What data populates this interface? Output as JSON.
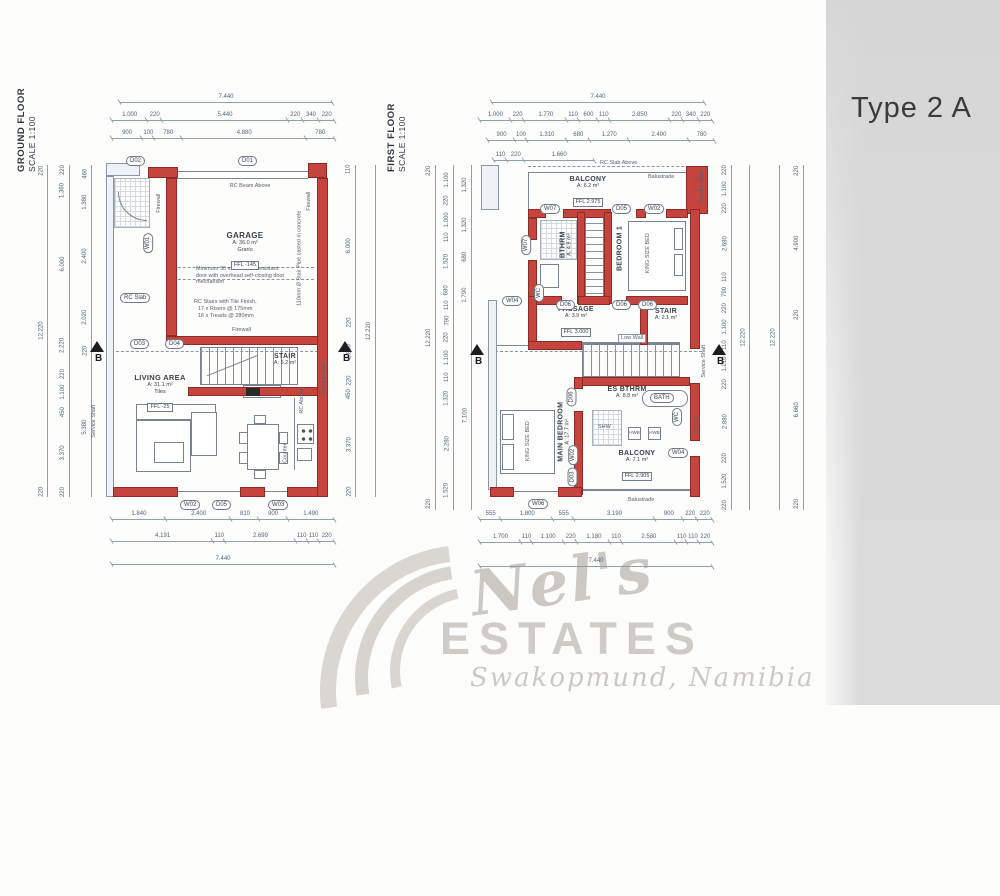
{
  "title": "Type 2 A",
  "watermark": {
    "name": "Nel's",
    "estates": "ESTATES",
    "location": "Swakopmund, Namibia"
  },
  "ground": {
    "floor_title": "GROUND FLOOR",
    "scale": "SCALE 1:100",
    "dims": {
      "top": [
        [
          "7.440"
        ],
        [
          "1.000",
          "220",
          "5.440",
          "220",
          "340",
          "220"
        ],
        [
          "900",
          "100",
          "780",
          "4.880",
          "780"
        ]
      ],
      "bottom": [
        [
          "1.840",
          "2.400",
          "810",
          "900",
          "1.490"
        ],
        [
          "4.191",
          "110",
          "2.699",
          "110",
          "110",
          "220"
        ],
        [
          "7.440"
        ]
      ],
      "left": [
        [
          "220",
          "12.220",
          "220"
        ],
        [
          "220",
          "1.360",
          "6.000",
          "2.220",
          "220",
          "1.100",
          "450",
          "3.370",
          "220"
        ],
        [
          "460",
          "1.380",
          "2.400",
          "2.020",
          "220",
          "5.380"
        ]
      ],
      "right": [
        [
          "110",
          "6.000",
          "220",
          "1.800",
          "220",
          "450",
          "3.370",
          "220"
        ],
        [
          "12.220"
        ]
      ]
    },
    "rooms": {
      "garage": {
        "name": "GARAGE",
        "area": "A: 36.0 m²",
        "finish": "Grano",
        "ffl": "FFL -145"
      },
      "stair": {
        "name": "STAIR",
        "area": "A: 5.2 m²"
      },
      "living": {
        "name": "LIVING AREA",
        "area": "A: 31.1 m²",
        "finish": "Tiles",
        "ffl": "FFL -25"
      }
    },
    "notes": {
      "rc_beam": "RC Beam Above",
      "fire_door": "Minimum 30 minutes fire resistant door with overhead self-closing door mechanism",
      "stairs1": "RC Stairs with Tile Finish,",
      "stairs2": "17 x Risers @ 175mm",
      "stairs3": "16 x Treads @ 280mm",
      "pipe": "110mm Ø Stair Pipe casted in concrete",
      "firewall": "Firewall",
      "rc_slab": "RC Slab",
      "rc_above": "RC Above",
      "counter": "Counter",
      "shaft": "Service Shaft",
      "section": "B"
    },
    "openings": {
      "d01": "D01",
      "d02": "D02",
      "d03": "D03",
      "d04": "D04",
      "d05": "D05",
      "w01": "W01",
      "w02": "W02",
      "w03": "W03"
    }
  },
  "first": {
    "floor_title": "FIRST FLOOR",
    "scale": "SCALE 1:100",
    "dims": {
      "top": [
        [
          "7.440"
        ],
        [
          "1.000",
          "220",
          "1.770",
          "110",
          "600",
          "110",
          "2.850",
          "220",
          "340",
          "220"
        ],
        [
          "900",
          "100",
          "1.310",
          "680",
          "1.270",
          "2.400",
          "780"
        ],
        [
          "110",
          "220",
          "1.660"
        ]
      ],
      "bottom": [
        [
          "555",
          "1.800",
          "555",
          "3.190",
          "900",
          "220",
          "220"
        ],
        [
          "1.700",
          "110",
          "1.100",
          "220",
          "1.180",
          "110",
          "2.580",
          "110",
          "110",
          "220"
        ],
        [
          "7.440"
        ]
      ],
      "left": [
        [
          "220",
          "12.220",
          "220"
        ],
        [
          "1.100",
          "220",
          "1.000",
          "110",
          "1.520",
          "680",
          "110",
          "790",
          "220",
          "1.100",
          "110",
          "1.320",
          "2.280",
          "1.520"
        ],
        [
          "1.320",
          "1.320",
          "680",
          "1.790",
          "7.100"
        ]
      ],
      "right": [
        [
          "220",
          "1.100",
          "220",
          "2.680",
          "110",
          "790",
          "220",
          "1.100",
          "110",
          "1.210",
          "220",
          "2.880",
          "220",
          "1.520",
          "220"
        ],
        [
          "12.220"
        ],
        [
          "12.220"
        ],
        [
          "220",
          "4.900",
          "220",
          "6.660",
          "220"
        ]
      ]
    },
    "rooms": {
      "balcony_top": {
        "name": "BALCONY",
        "area": "A: 6.2 m²",
        "finish": "Tiles",
        "ffl": "FFL 2.975"
      },
      "bthrm": {
        "name": "BTHRM",
        "area": "A: 4.9 m²",
        "finish": "Tiles"
      },
      "bedroom1": {
        "name": "BEDROOM 1",
        "bed": "KING SIZE BED"
      },
      "passage": {
        "name": "PASSAGE",
        "area": "A: 3.9 m²",
        "finish": "Tiles",
        "ffl": "FFL 3.000"
      },
      "stair": {
        "name": "STAIR",
        "area": "A: 2.1 m²"
      },
      "es_bthrm": {
        "name": "ES BTHRM",
        "area": "A: 8.8 m²",
        "finish": "Tiles"
      },
      "main_bedroom": {
        "name": "MAIN BEDROOM",
        "area": "A: 17.7 m²",
        "bed": "KING SIZE BED"
      },
      "balcony_bottom": {
        "name": "BALCONY",
        "area": "A: 7.1 m²",
        "finish": "Tiles",
        "ffl": "FFL 2.905"
      }
    },
    "notes": {
      "rc_slab_above": "RC Slab Above",
      "balustrade": "Balustrade",
      "low_wall": "Low Wall",
      "bath": "BATH",
      "wc": "WC",
      "shw": "SHW",
      "hwb": "HWB",
      "vp": "VP 550",
      "shaft": "Service Shaft",
      "section": "B"
    },
    "openings": {
      "w07": "W07",
      "d05": "D05",
      "w02": "W02",
      "w04": "W04",
      "w06": "W06",
      "d03": "D03",
      "d06": "D06"
    }
  }
}
